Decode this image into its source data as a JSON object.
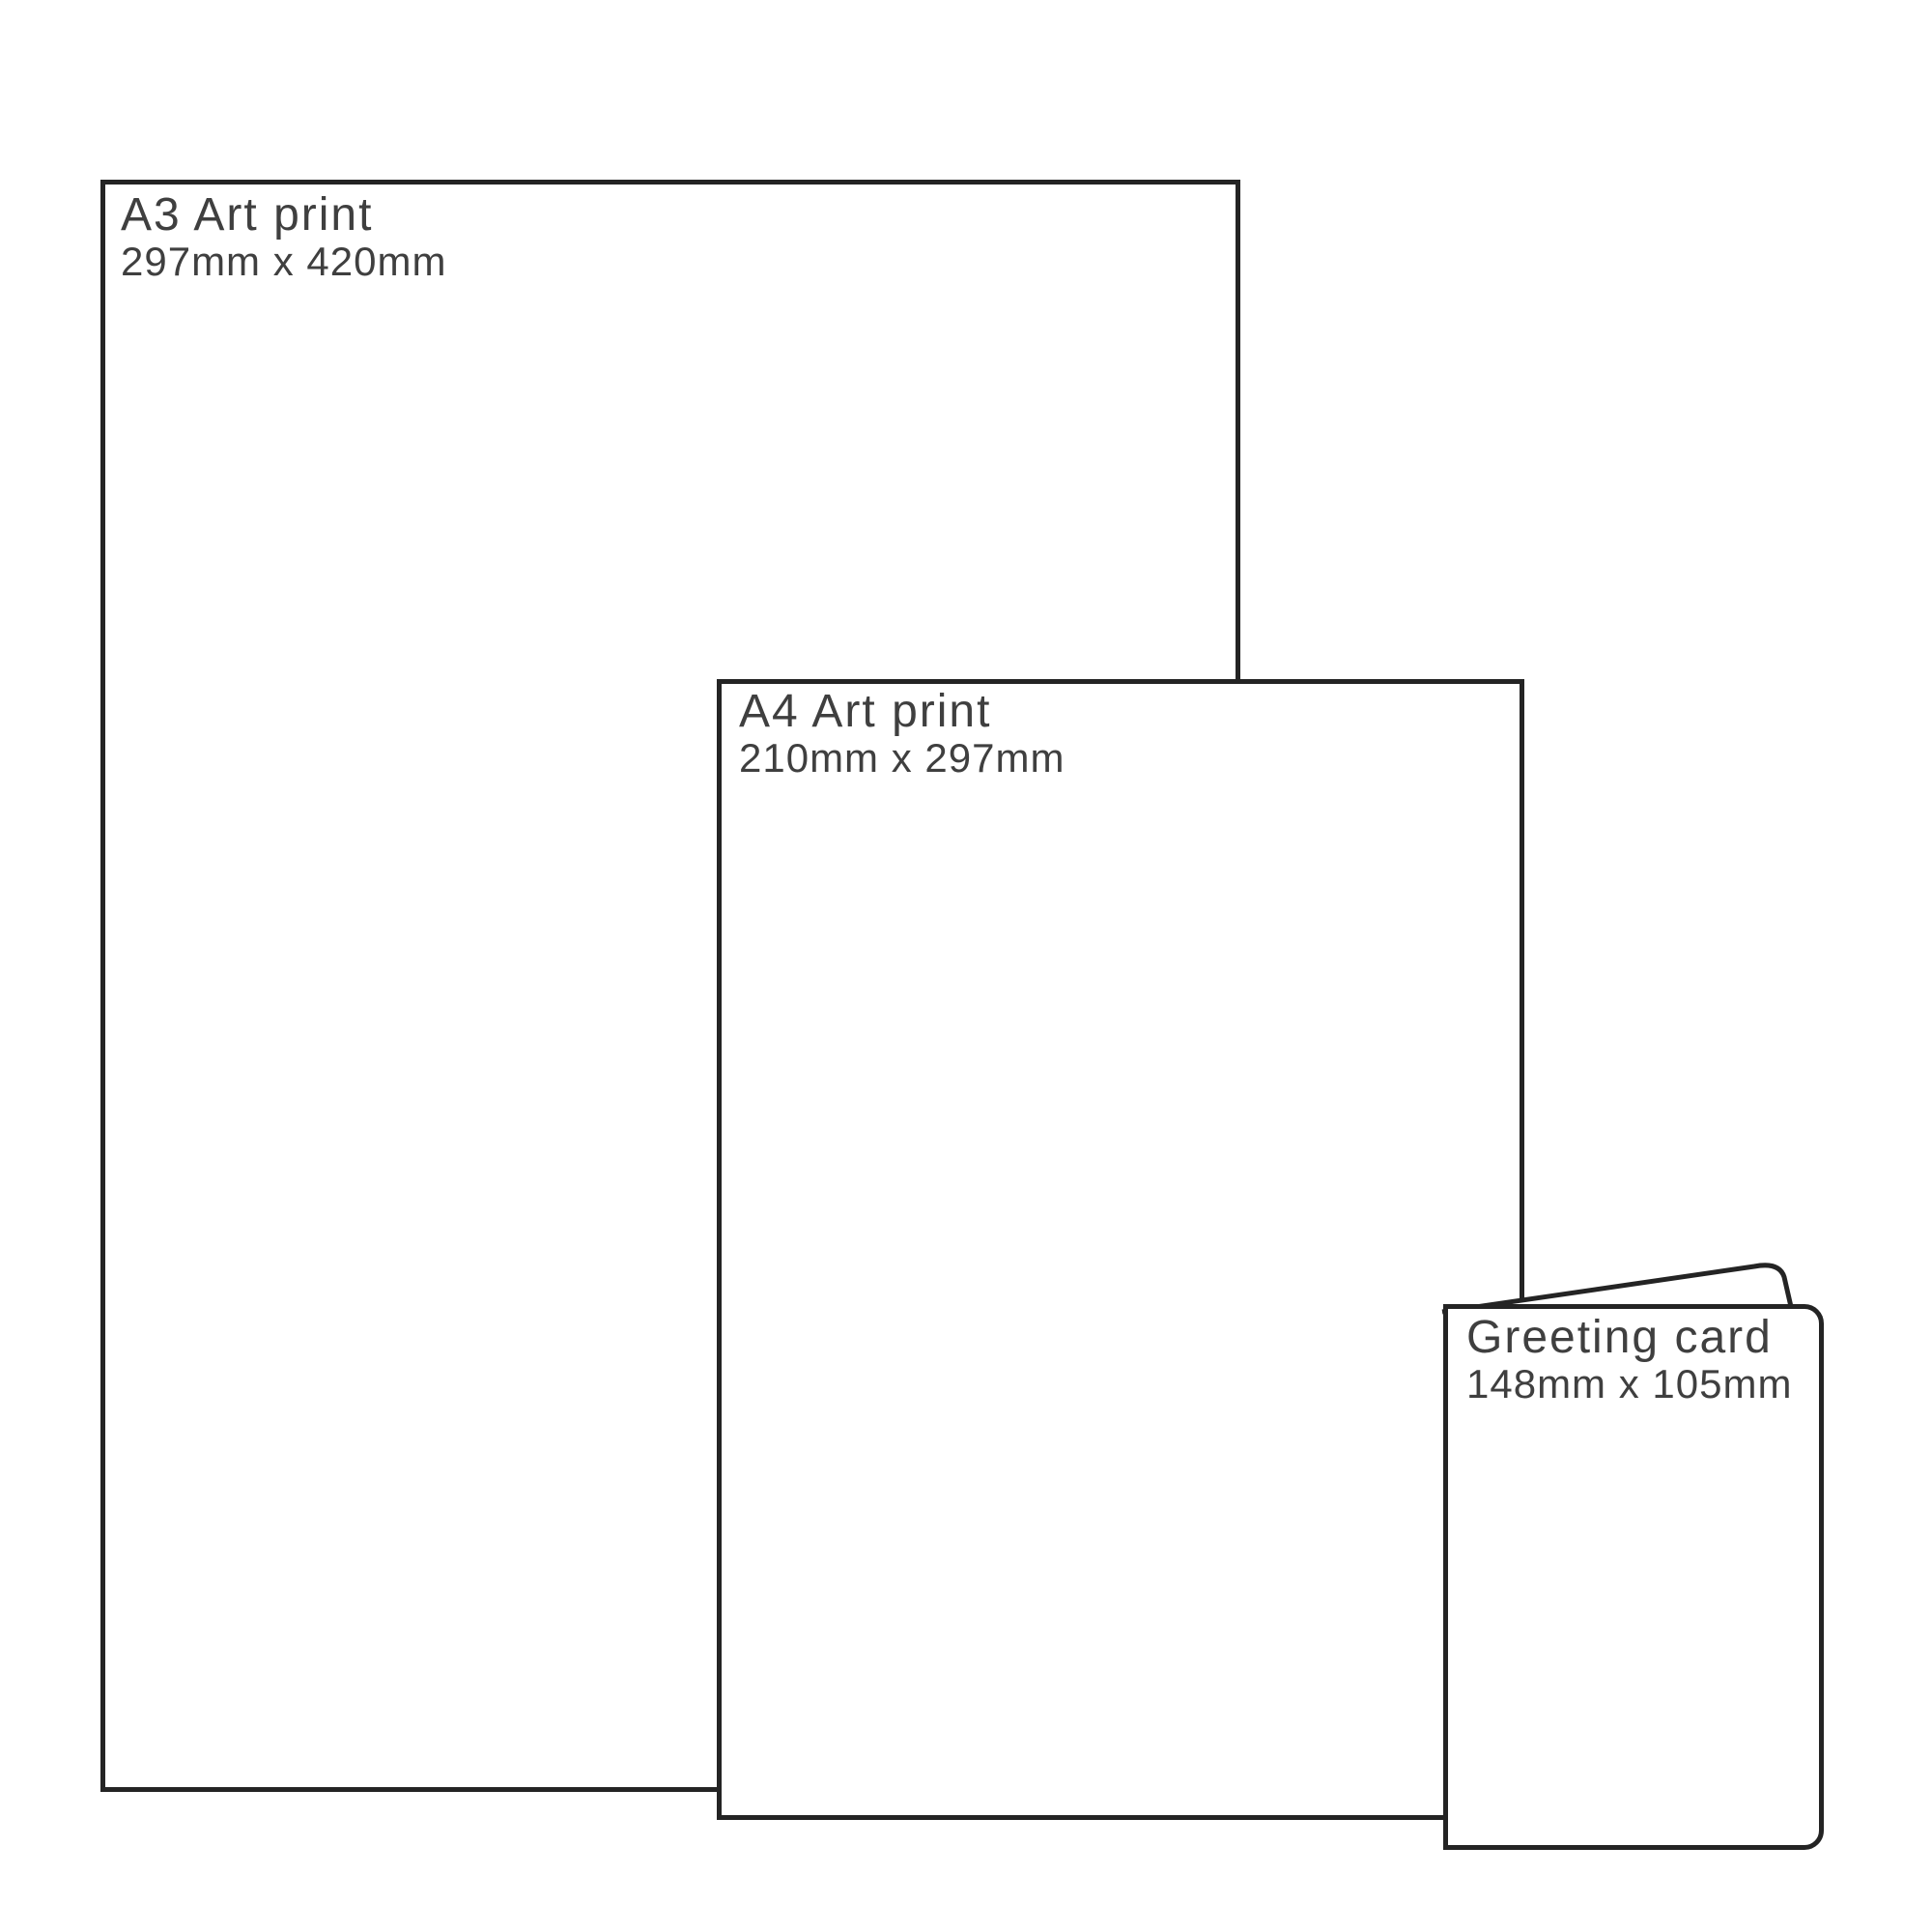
{
  "page": {
    "background_color": "#ffffff",
    "outline_color": "#242424",
    "label_color": "#3f3f3f"
  },
  "sizes": [
    {
      "id": "a3-print",
      "title": "A3 Art print",
      "dimensions": "297mm x 420mm"
    },
    {
      "id": "a4-print",
      "title": "A4 Art print",
      "dimensions": "210mm x 297mm"
    },
    {
      "id": "greeting-card",
      "title": "Greeting card",
      "dimensions": "148mm x 105mm"
    }
  ]
}
